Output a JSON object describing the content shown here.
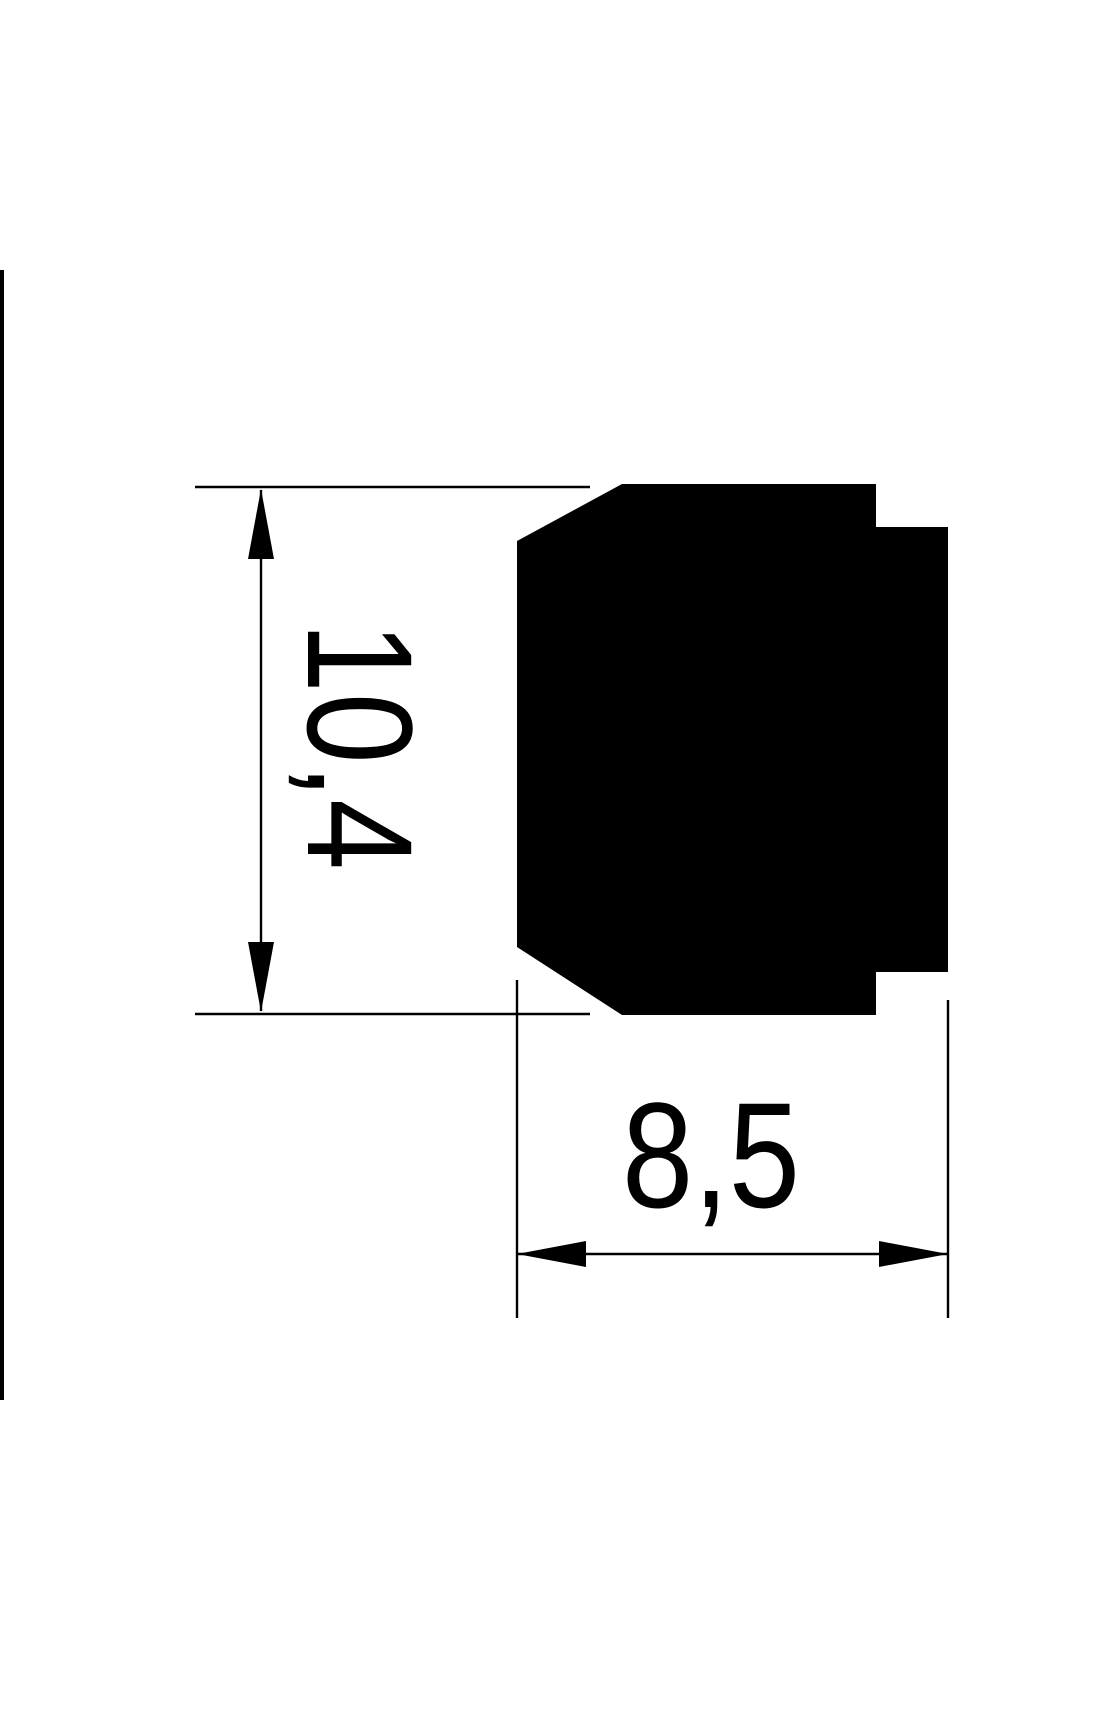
{
  "page": {
    "background_color": "#ffffff",
    "ink_color": "#000000"
  },
  "drawing": {
    "type": "profile-cross-section-dimension-drawing",
    "vertical_dimension": {
      "label": "10,4",
      "value": 10.4,
      "orientation": "vertical"
    },
    "horizontal_dimension": {
      "label": "8,5",
      "value": 8.5,
      "orientation": "horizontal"
    }
  }
}
